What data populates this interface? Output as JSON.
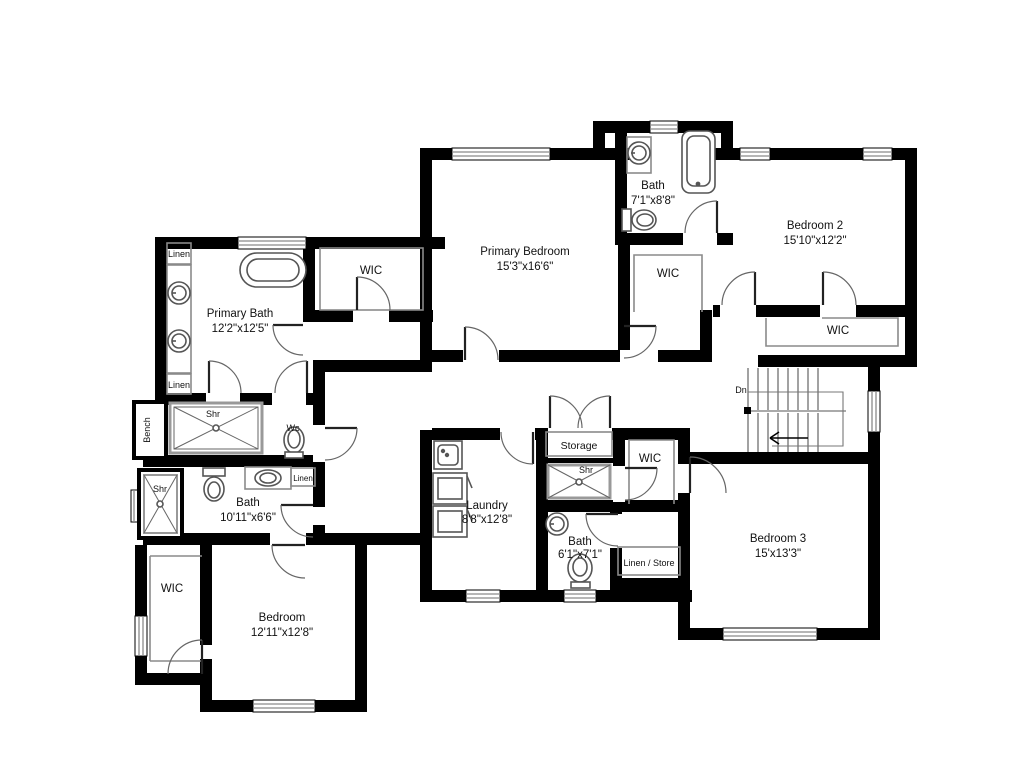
{
  "floorplan": {
    "rooms": {
      "primary_bath": {
        "name": "Primary Bath",
        "dims": "12'2\"x12'5\""
      },
      "primary_bedroom": {
        "name": "Primary Bedroom",
        "dims": "15'3\"x16'6\""
      },
      "bath_top": {
        "name": "Bath",
        "dims": "7'1\"x8'8\""
      },
      "bedroom2": {
        "name": "Bedroom 2",
        "dims": "15'10\"x12'2\""
      },
      "bedroom3": {
        "name": "Bedroom 3",
        "dims": "15'x13'3\""
      },
      "bath_hall": {
        "name": "Bath",
        "dims": "10'11\"x6'6\""
      },
      "bath_mid": {
        "name": "Bath",
        "dims": "6'1\"x7'1\""
      },
      "laundry": {
        "name": "Laundry",
        "dims": "8'8\"x12'8\""
      },
      "bedroom_bl": {
        "name": "Bedroom",
        "dims": "12'11\"x12'8\""
      }
    },
    "labels": {
      "wic": "WIC",
      "linen": "Linen",
      "shr": "Shr",
      "wc": "Wc",
      "bench": "Bench",
      "dn": "Dn",
      "storage": "Storage",
      "linen_store": "Linen / Store"
    },
    "colors": {
      "wall": "#000000",
      "background": "#ffffff",
      "fixture_stroke": "#555555",
      "thin_line": "#8a8a8a"
    }
  }
}
